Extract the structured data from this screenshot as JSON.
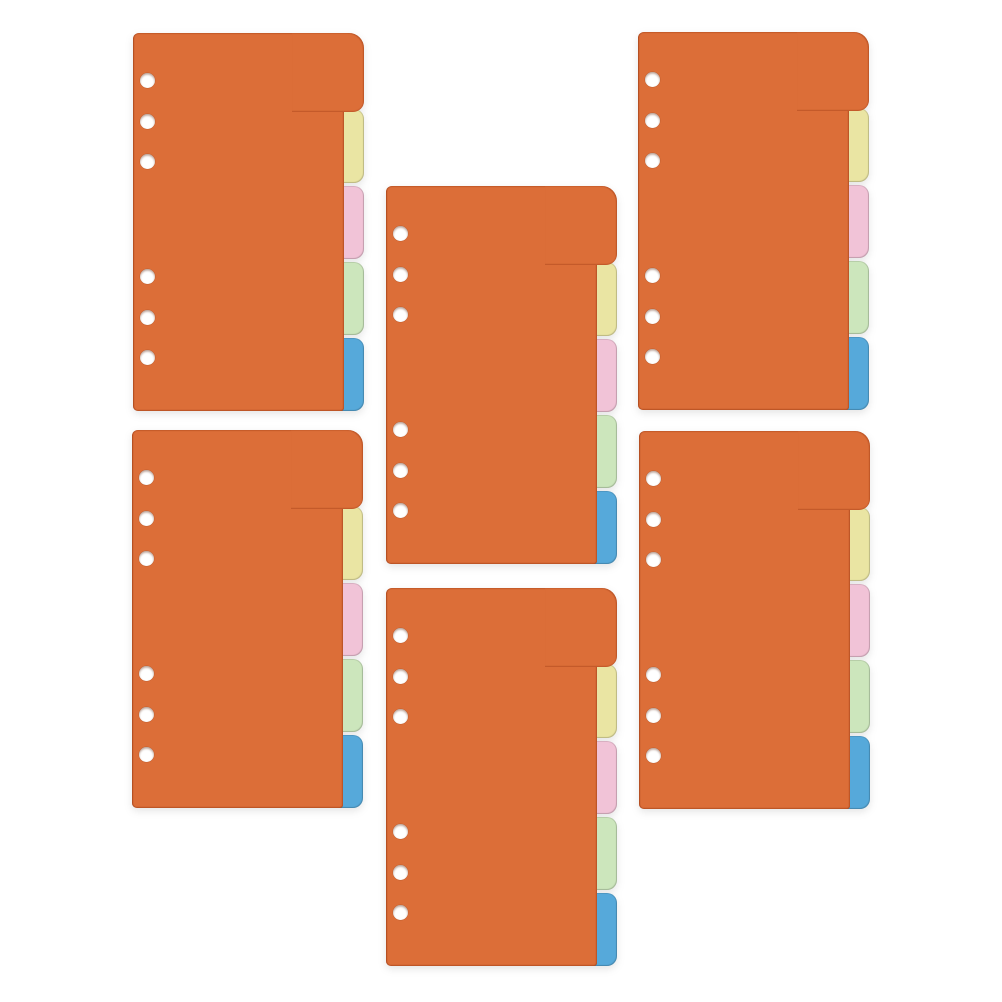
{
  "photo": {
    "description": "Six orange binder index divider sheets arranged in two staggered columns on a white background, each sheet with six ring-binder punch holes on the left and five staggered index tabs on the right edge",
    "background_color": "#ffffff"
  },
  "divider_set": {
    "count": 6,
    "page": {
      "color": "#dc6e38",
      "edge_color": "#a8481c",
      "hole_count": 6,
      "hole_color": "#ffffff"
    },
    "tabs": [
      {
        "name": "orange",
        "color": "#dc6e38"
      },
      {
        "name": "yellow",
        "color": "#eae5a3"
      },
      {
        "name": "pink",
        "color": "#f1c3d7"
      },
      {
        "name": "green",
        "color": "#cce6bc"
      },
      {
        "name": "blue",
        "color": "#56a9da"
      }
    ],
    "units": [
      {
        "position": "top-left"
      },
      {
        "position": "top-right"
      },
      {
        "position": "middle-upper"
      },
      {
        "position": "bottom-left"
      },
      {
        "position": "bottom-right"
      },
      {
        "position": "middle-lower"
      }
    ]
  }
}
